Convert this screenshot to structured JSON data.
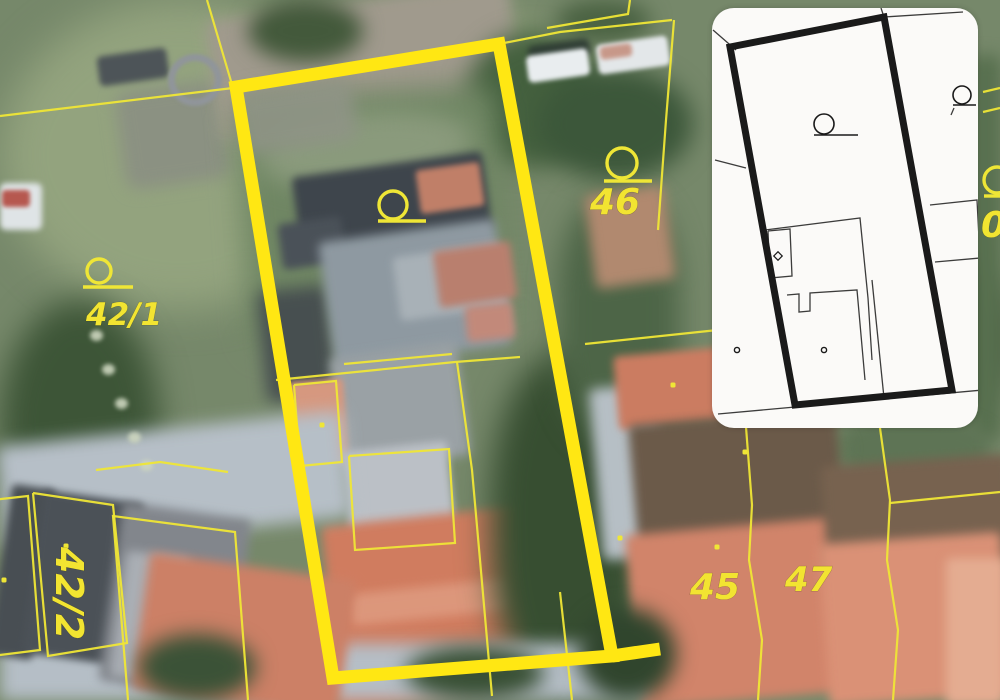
{
  "scene": {
    "kind": "aerial-photo-with-cadastral-overlay",
    "colors": {
      "cadastral_yellow": "#efe636",
      "highlight_yellow": "#ffe713",
      "label_yellow": "#f2e431",
      "inset_background": "#fbfaf8",
      "inset_ink": "#1a1a1a"
    }
  },
  "parcel_labels": [
    {
      "name": "42-1",
      "text": "42/1",
      "x": 86,
      "y": 325,
      "size": 31,
      "transform": ""
    },
    {
      "name": "42-2",
      "text": "42/2",
      "x": 0,
      "y": 0,
      "size": 38,
      "transform": "translate(56,547) rotate(90)"
    },
    {
      "name": "41",
      "text": "41",
      "x": 224,
      "y": 627,
      "size": 32,
      "transform": "rotate(-8 224 627)"
    },
    {
      "name": "45",
      "text": "45",
      "x": 690,
      "y": 599,
      "size": 36,
      "transform": ""
    },
    {
      "name": "46",
      "text": "46",
      "x": 590,
      "y": 214,
      "size": 36,
      "transform": ""
    },
    {
      "name": "47",
      "text": "47",
      "x": 785,
      "y": 591,
      "size": 34,
      "transform": ""
    },
    {
      "name": "0-partial",
      "text": "0",
      "x": 981,
      "y": 237,
      "size": 36,
      "transform": ""
    }
  ],
  "point_markers": [
    {
      "cx": 393,
      "cy": 205,
      "r": 14,
      "tail": [
        378,
        221,
        426,
        221
      ]
    },
    {
      "cx": 622,
      "cy": 163,
      "r": 15,
      "tail": [
        604,
        181,
        652,
        181
      ]
    },
    {
      "cx": 99,
      "cy": 271,
      "r": 12,
      "tail": [
        83,
        287,
        133,
        287
      ]
    },
    {
      "cx": 997,
      "cy": 180,
      "r": 13,
      "tail": [
        984,
        196,
        1000,
        196
      ]
    }
  ],
  "boundary_dots": [
    [
      322,
      425
    ],
    [
      673,
      385
    ],
    [
      745,
      452
    ],
    [
      620,
      538
    ],
    [
      717,
      547
    ],
    [
      66,
      546
    ],
    [
      4,
      580
    ]
  ],
  "boundary_lines": [
    [
      [
        0,
        116
      ],
      [
        233,
        88
      ]
    ],
    [
      [
        207,
        0
      ],
      [
        233,
        88
      ]
    ],
    [
      [
        499,
        44
      ],
      [
        560,
        32
      ],
      [
        672,
        20
      ]
    ],
    [
      [
        547,
        28
      ],
      [
        628,
        14
      ],
      [
        630,
        0
      ]
    ],
    [
      [
        674,
        20
      ],
      [
        666,
        120
      ],
      [
        658,
        230
      ]
    ],
    [
      [
        276,
        380
      ],
      [
        455,
        362
      ],
      [
        520,
        357
      ]
    ],
    [
      [
        457,
        362
      ],
      [
        472,
        470
      ],
      [
        480,
        560
      ],
      [
        492,
        696
      ]
    ],
    [
      [
        560,
        592
      ],
      [
        572,
        700
      ]
    ],
    [
      [
        344,
        364
      ],
      [
        452,
        354
      ]
    ],
    [
      [
        294,
        385
      ],
      [
        336,
        381
      ],
      [
        342,
        462
      ],
      [
        300,
        466
      ],
      [
        294,
        385
      ]
    ],
    [
      [
        349,
        456
      ],
      [
        449,
        449
      ],
      [
        455,
        543
      ],
      [
        355,
        550
      ],
      [
        349,
        456
      ]
    ],
    [
      [
        585,
        344
      ],
      [
        746,
        327
      ]
    ],
    [
      [
        746,
        427
      ],
      [
        752,
        505
      ],
      [
        749,
        560
      ],
      [
        762,
        640
      ],
      [
        758,
        700
      ]
    ],
    [
      [
        880,
        428
      ],
      [
        890,
        500
      ],
      [
        887,
        560
      ],
      [
        898,
        630
      ],
      [
        893,
        700
      ]
    ],
    [
      [
        890,
        503
      ],
      [
        1000,
        492
      ]
    ],
    [
      [
        33,
        493
      ],
      [
        113,
        505
      ],
      [
        127,
        643
      ],
      [
        48,
        656
      ],
      [
        33,
        493
      ]
    ],
    [
      [
        -8,
        500
      ],
      [
        28,
        496
      ],
      [
        40,
        650
      ],
      [
        -8,
        656
      ]
    ],
    [
      [
        128,
        700
      ],
      [
        113,
        516
      ],
      [
        235,
        532
      ],
      [
        248,
        700
      ]
    ],
    [
      [
        96,
        470
      ],
      [
        160,
        462
      ],
      [
        228,
        472
      ]
    ],
    [
      [
        983,
        92
      ],
      [
        1000,
        88
      ]
    ],
    [
      [
        983,
        112
      ],
      [
        1000,
        108
      ]
    ]
  ],
  "highlighted_parcel": {
    "points": "236,87 499,44 612,656 333,678",
    "stub": [
      [
        612,
        656
      ],
      [
        660,
        649
      ]
    ],
    "stroke_width": 13
  },
  "inset_plan": {
    "outline": {
      "points": "18,39 172,9 240,382 83,397",
      "stroke_width": 7
    },
    "thin_lines": [
      [
        [
          1,
          22
        ],
        [
          24,
          42
        ]
      ],
      [
        [
          172,
          9
        ],
        [
          251,
          4
        ]
      ],
      [
        [
          172,
          9
        ],
        [
          169,
          0
        ]
      ],
      [
        [
          3,
          152
        ],
        [
          34,
          160
        ]
      ],
      [
        [
          53,
          222
        ],
        [
          148,
          210
        ],
        [
          156,
          290
        ],
        [
          160,
          352
        ]
      ],
      [
        [
          56,
          223
        ],
        [
          78,
          221
        ],
        [
          80,
          268
        ],
        [
          58,
          270
        ],
        [
          56,
          223
        ]
      ],
      [
        [
          75,
          287
        ],
        [
          87,
          286
        ],
        [
          87,
          304
        ],
        [
          98,
          303
        ],
        [
          98,
          285
        ],
        [
          145,
          282
        ],
        [
          153,
          372
        ]
      ],
      [
        [
          160,
          272
        ],
        [
          172,
          390
        ]
      ],
      [
        [
          6,
          406
        ],
        [
          271,
          382
        ]
      ],
      [
        [
          218,
          197
        ],
        [
          265,
          192
        ],
        [
          268,
          250
        ],
        [
          223,
          254
        ]
      ],
      [
        [
          242,
          100
        ],
        [
          239,
          107
        ]
      ]
    ],
    "point_markers": [
      {
        "cx": 112,
        "cy": 116,
        "r": 10,
        "tail": [
          102,
          127,
          146,
          127
        ]
      },
      {
        "cx": 250,
        "cy": 87,
        "r": 9,
        "tail": [
          241,
          97,
          264,
          97
        ]
      }
    ],
    "small_circles": [
      [
        25,
        342
      ],
      [
        112,
        342
      ]
    ],
    "diamond": [
      66,
      248
    ]
  }
}
